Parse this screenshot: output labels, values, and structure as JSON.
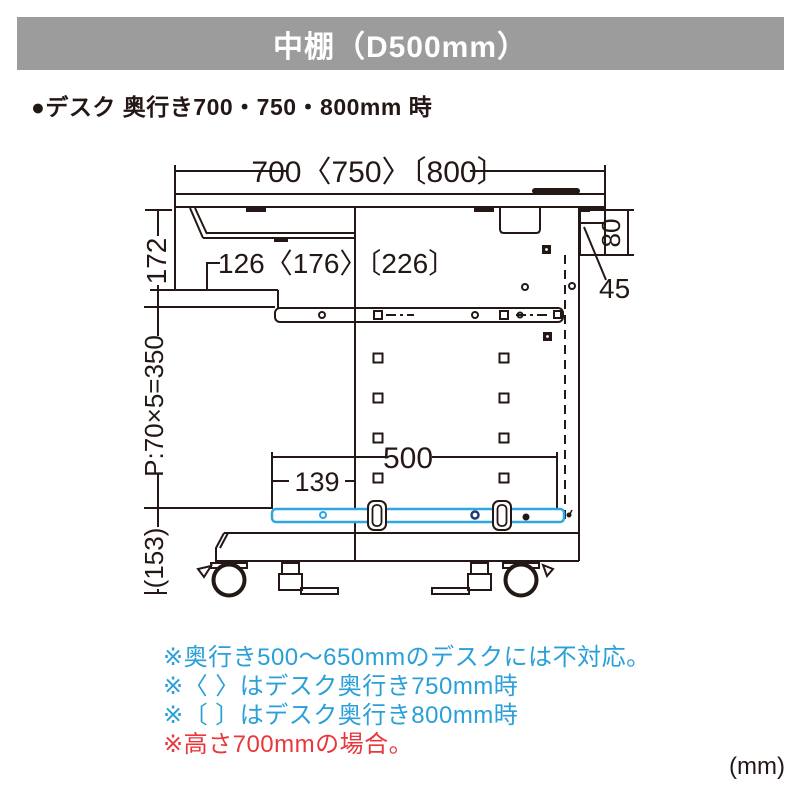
{
  "header": {
    "title": "中棚（D500mm）"
  },
  "subtitle": {
    "text": "●デスク 奥行き700・750・800mm 時"
  },
  "diagram": {
    "dims": {
      "top_width": "700〈750〉〔800〕",
      "tray_inset": "126〈176〉〔226〕",
      "upper_height": "172",
      "pitch": "P:70×5=350",
      "caster_height": "(153)",
      "rear_beam_height": "80",
      "rear_beam_depth": "45",
      "shelf_depth": "500",
      "shelf_front_offset": "139"
    },
    "unit_label": "(mm)"
  },
  "notes": [
    {
      "text": "※奥行き500〜650mmのデスクには不対応。",
      "color": "#2a9fd8"
    },
    {
      "text": "※〈 〉はデスク奥行き750mm時",
      "color": "#2a9fd8"
    },
    {
      "text": "※〔 〕はデスク奥行き800mm時",
      "color": "#2a9fd8"
    },
    {
      "text": "※高さ700mmの場合。",
      "color": "#e8383d"
    }
  ],
  "palette": {
    "header_bg": "#9c9c9d",
    "line": "#231815",
    "shelf_highlight": "#2ea7e0",
    "note_blue": "#2a9fd8",
    "note_red": "#e8383d"
  }
}
